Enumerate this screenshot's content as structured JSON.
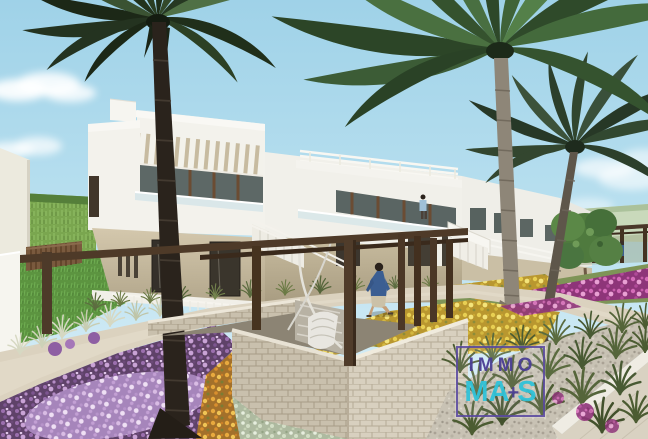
{
  "watermark": {
    "brand_top": "IMMO",
    "brand_ma": "MA",
    "brand_plus": "+",
    "brand_s": "S",
    "frame_color": "#5a49a0",
    "top_text_color": "#4a3e94",
    "bottom_text_color": "#2fc2d8"
  },
  "palette": {
    "sky": "#a6d7ea",
    "building_white": "#f4f3ee",
    "building_beige": "#cec2a7",
    "window_frame_brown": "#6b4c33",
    "pergola_wood": "#4d3926",
    "stone_wall": "#d7cfbe",
    "path": "#dcd3c0",
    "lawn": "#5c9440",
    "flowers_purple": "#9b6fae",
    "flowers_yellow": "#e3c74e",
    "flowers_orange": "#d98f2e",
    "flowers_magenta": "#d46cb8",
    "palm_green": "#3f6338",
    "palm_trunk_dark": "#2a231c"
  },
  "scene": {
    "type": "3d-architectural-rendering",
    "subject": "Modern white two-storey townhouse row with palm trees, flower gardens, stone planter courtyard with pergola and hanging chair, man walking on path",
    "elements": [
      "sky",
      "clouds",
      "green-field",
      "wooden-fence",
      "lawn",
      "townhouse-row",
      "roof-louvers",
      "glass-balcony",
      "staircases",
      "pergola",
      "stone-planter",
      "hanging-chair",
      "walking-person",
      "distant-people",
      "palm-trees",
      "flower-beds",
      "gravel-garden",
      "walkway",
      "brand-watermark"
    ]
  }
}
